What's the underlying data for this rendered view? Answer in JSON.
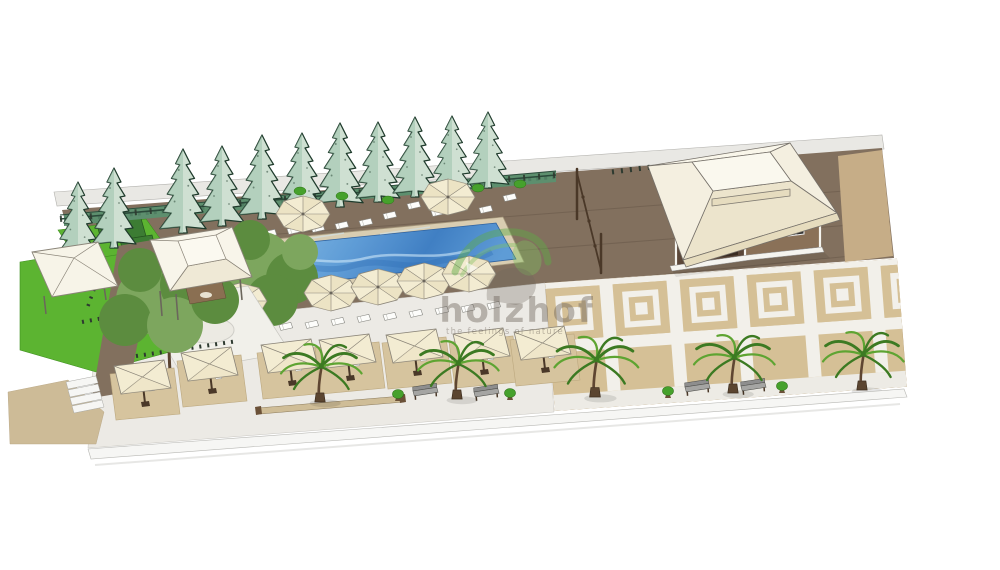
{
  "watermark": {
    "brand": "holzhof",
    "tagline": "the feelings of nature"
  },
  "colors": {
    "bg": "#ffffff",
    "band": "#e9e8e4",
    "bandline": "#b3b2ae",
    "deck": "#82705e",
    "deckline": "rgba(50,38,26,0.18)",
    "terrace": "#eceae5",
    "terraceline": "#c8c6c0",
    "plaza": "#d5c096",
    "plazadark": "#c6ad87",
    "plazaline": "#b39a72",
    "strip": "#f2f0ea",
    "walkway": "#edebe5",
    "pad": "#d6c49e",
    "padline": "#bca87f",
    "lawn": "#5cb431",
    "lawnline": "#3e8f1f",
    "hedge": "#3c7c33",
    "hedgeline": "#24541e",
    "hedgeband": "#5d8f6e",
    "hedgebandline": "#456f57",
    "fence": "#2b4a3a",
    "conifer1": "#cfe0d2",
    "conifer2": "#9dc2ab",
    "coniferline": "#1f3b2c",
    "coping": "#d9cdb1",
    "copingline": "#a5977b",
    "water1": "#8fc3ec",
    "water2": "#5b9bd8",
    "water3": "#3c7dc4",
    "waterdark": "#2e6cb4",
    "waterlight": "#cfe8f8",
    "canopy": "#f3ecd2",
    "canopyshade": "#e7ddba",
    "canopyline": "#8a8478",
    "rooftop": "#f9f6ea",
    "roofside": "#f4efe0",
    "rooffront": "#ece4cc",
    "roofline": "#76716a",
    "fascia": "#e6dcbe",
    "wall": "#8a7158",
    "walldark": "#5b4739",
    "door": "#3a2c22",
    "window": "#2f2f2f",
    "whitebase": "#f5f4ef",
    "trunk": "#5f4632",
    "palm1": "#3c7a22",
    "palm2": "#5ea432",
    "olive1": "#7da65e",
    "olive2": "#5c8c3f",
    "bench": "#a5a5a3",
    "benchback": "#8e8e8e",
    "benchline": "#4e4e4a",
    "wood": "#4a3828",
    "shrub": "#46a12c",
    "shrubline": "#2e7218",
    "curb": "#f6f6f4",
    "curbline": "#b8b8b4",
    "sand": "#cdbb97",
    "sandline": "#b3a07c",
    "post": "#2e3a30",
    "chair": "#fbfbf9",
    "chairline": "#9a9a94",
    "lounger": "#fdfdfb",
    "loungerline": "#8a8a85",
    "wmgray": "rgba(105,96,86,0.42)",
    "wmgreen": "rgba(95,170,70,0.45)",
    "wmgreen2": "rgba(125,195,95,0.38)"
  },
  "scene": {
    "view": "aerial 3d sketch render of resort pool area",
    "areas": [
      "wooden pool deck",
      "swimming pool",
      "dining terrace",
      "paved plaza",
      "lawn",
      "walkway"
    ],
    "structures": [
      "pavilion",
      "cabana",
      "gazebo",
      "fence",
      "steps"
    ],
    "furniture": {
      "sun_loungers": 23,
      "round_pool_umbrellas": 7,
      "square_dining_umbrellas": 7,
      "benches": 4,
      "planters": 3
    },
    "vegetation": {
      "conifer_trees": 11,
      "palm_trees": 5,
      "deciduous_trees": 2,
      "hedge_blocks": 2,
      "shrubs": 6
    }
  }
}
